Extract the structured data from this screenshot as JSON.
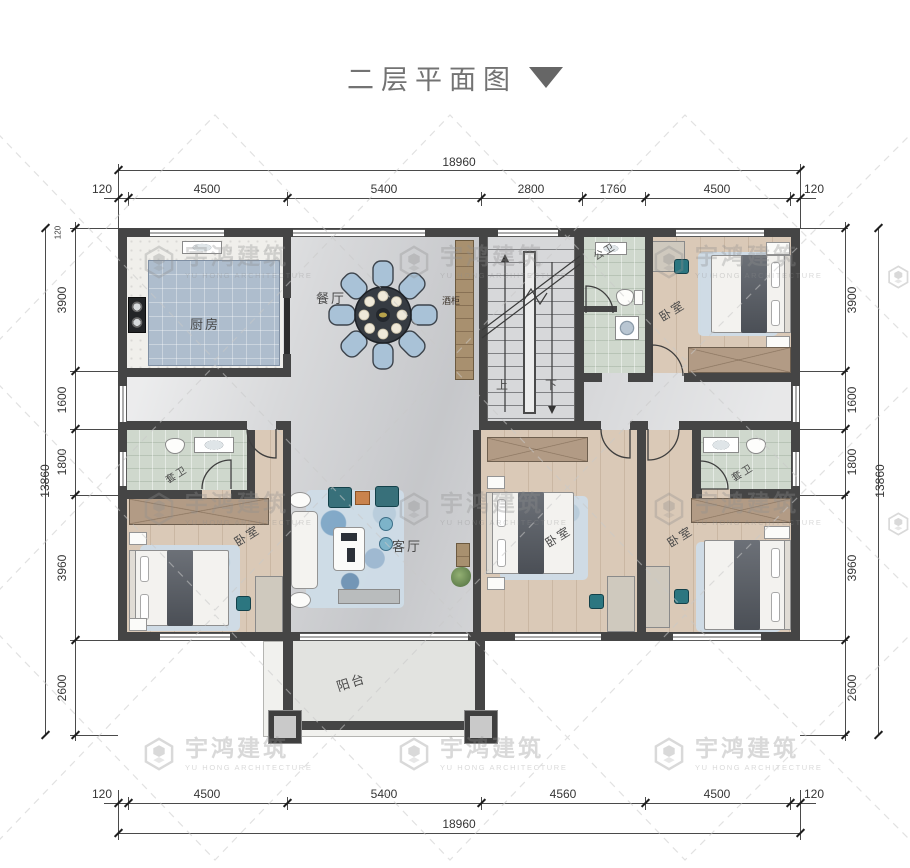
{
  "title": {
    "text": "二层平面图"
  },
  "watermark": {
    "name": "宇鸿建筑",
    "sub": "YU HONG ARCHITECTURE"
  },
  "dimensions": {
    "top": {
      "total": "18960",
      "segments": [
        "120",
        "4500",
        "5400",
        "2800",
        "1760",
        "4500",
        "120"
      ]
    },
    "bottom": {
      "total": "18960",
      "segments": [
        "120",
        "4500",
        "5400",
        "4560",
        "4500",
        "120"
      ]
    },
    "left": {
      "total": "13860",
      "wall_offset": "120",
      "segments": [
        "3900",
        "1600",
        "1800",
        "3960",
        "2600"
      ]
    },
    "right": {
      "total": "13860",
      "segments": [
        "3900",
        "1600",
        "1800",
        "3960",
        "2600"
      ]
    }
  },
  "rooms": {
    "kitchen": "厨房",
    "dining": "餐厅",
    "wine_cabinet": "酒柜",
    "public_bath": "公卫",
    "ensuite_bath": "套卫",
    "bedroom": "卧室",
    "living": "客厅",
    "balcony": "阳台",
    "stairs_up": "上",
    "stairs_down": "下"
  },
  "colors": {
    "wall": "#454545",
    "marble_floor": "#d8d9db",
    "wood_floor": "#dac9b7",
    "tile_floor": "#cfd8cd",
    "kitchen_mat": "#aebdcd",
    "teal_accent": "#2c7680",
    "dining_chair_blue": "#a9c2d7",
    "wardrobe_brown": "#b29b85"
  }
}
